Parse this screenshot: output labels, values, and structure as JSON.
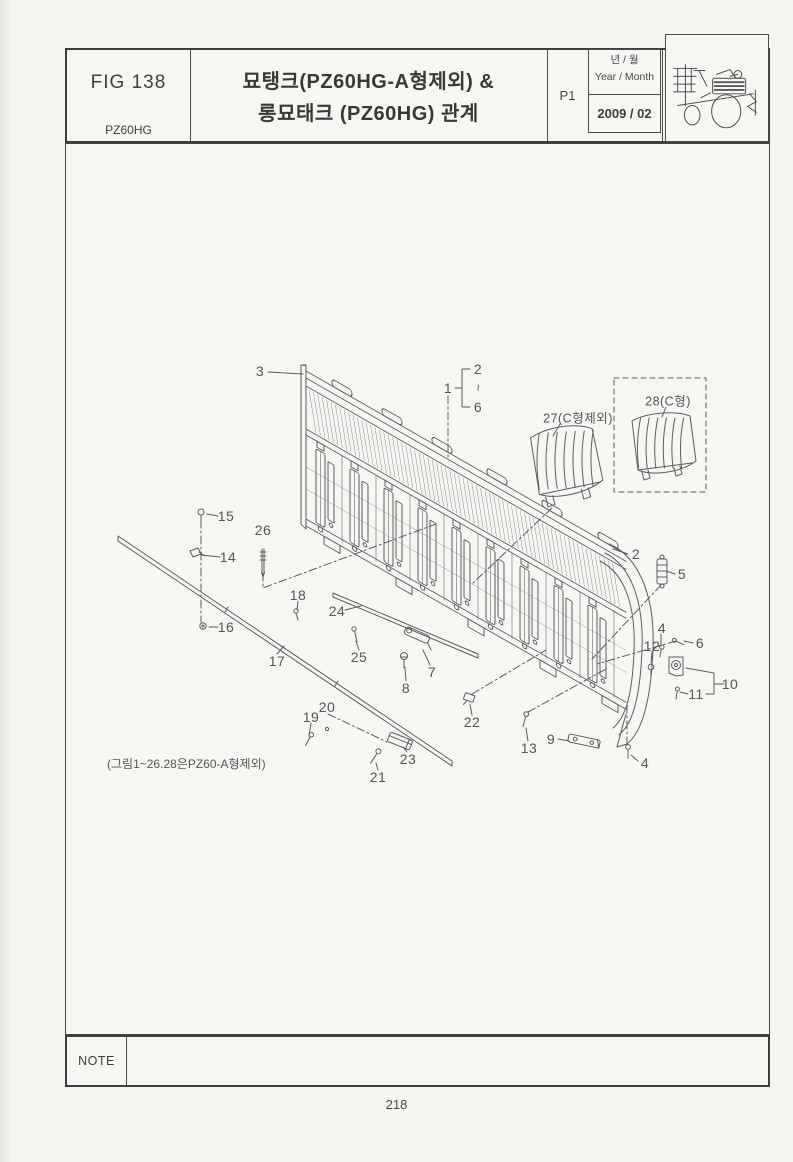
{
  "header": {
    "fig_label": "FIG 138",
    "model": "PZ60HG",
    "title_line1": "묘탱크(PZ60HG-A형제외) &",
    "title_line2": "롱묘태크 (PZ60HG) 관계",
    "page_code": "P1",
    "year_month_ko": "년 / 월",
    "year_month_en": "Year / Month",
    "date": "2009 / 02",
    "logo_icon": "rice-transplanter-illustration"
  },
  "note": {
    "label": "NOTE"
  },
  "page": {
    "number": "218"
  },
  "diagram": {
    "caption": "(그림1~26.28은PZ60-A형제외)",
    "callouts": [
      {
        "id": "3",
        "label": "3",
        "x": 260,
        "y": 371
      },
      {
        "id": "1",
        "label": "1",
        "x": 448,
        "y": 388
      },
      {
        "id": "2-top",
        "label": "2",
        "x": 478,
        "y": 369
      },
      {
        "id": "range-tilde",
        "label": "~",
        "x": 478,
        "y": 388,
        "cls": "squiggle"
      },
      {
        "id": "6-top",
        "label": "6",
        "x": 478,
        "y": 407
      },
      {
        "id": "27",
        "label": "27(C형제외)",
        "x": 578,
        "y": 417,
        "cls": "small"
      },
      {
        "id": "28",
        "label": "28(C형)",
        "x": 668,
        "y": 400,
        "cls": "small"
      },
      {
        "id": "2-right",
        "label": "2",
        "x": 636,
        "y": 554
      },
      {
        "id": "5",
        "label": "5",
        "x": 682,
        "y": 574
      },
      {
        "id": "4-right",
        "label": "4",
        "x": 662,
        "y": 628
      },
      {
        "id": "6-right",
        "label": "6",
        "x": 700,
        "y": 643
      },
      {
        "id": "12",
        "label": "12",
        "x": 652,
        "y": 646
      },
      {
        "id": "10",
        "label": "10",
        "x": 730,
        "y": 684
      },
      {
        "id": "11",
        "label": "11",
        "x": 696,
        "y": 694
      },
      {
        "id": "15",
        "label": "15",
        "x": 226,
        "y": 516
      },
      {
        "id": "14",
        "label": "14",
        "x": 228,
        "y": 557
      },
      {
        "id": "26",
        "label": "26",
        "x": 263,
        "y": 530
      },
      {
        "id": "16",
        "label": "16",
        "x": 226,
        "y": 627
      },
      {
        "id": "18",
        "label": "18",
        "x": 298,
        "y": 595
      },
      {
        "id": "24",
        "label": "24",
        "x": 337,
        "y": 611
      },
      {
        "id": "17",
        "label": "17",
        "x": 277,
        "y": 661
      },
      {
        "id": "25",
        "label": "25",
        "x": 359,
        "y": 657
      },
      {
        "id": "7",
        "label": "7",
        "x": 432,
        "y": 672
      },
      {
        "id": "8",
        "label": "8",
        "x": 406,
        "y": 688
      },
      {
        "id": "19",
        "label": "19",
        "x": 311,
        "y": 717
      },
      {
        "id": "20",
        "label": "20",
        "x": 327,
        "y": 707
      },
      {
        "id": "22",
        "label": "22",
        "x": 472,
        "y": 722
      },
      {
        "id": "23",
        "label": "23",
        "x": 408,
        "y": 759
      },
      {
        "id": "21",
        "label": "21",
        "x": 378,
        "y": 777
      },
      {
        "id": "13",
        "label": "13",
        "x": 529,
        "y": 748
      },
      {
        "id": "9",
        "label": "9",
        "x": 551,
        "y": 739
      },
      {
        "id": "4-bottom",
        "label": "4",
        "x": 645,
        "y": 763
      }
    ]
  }
}
